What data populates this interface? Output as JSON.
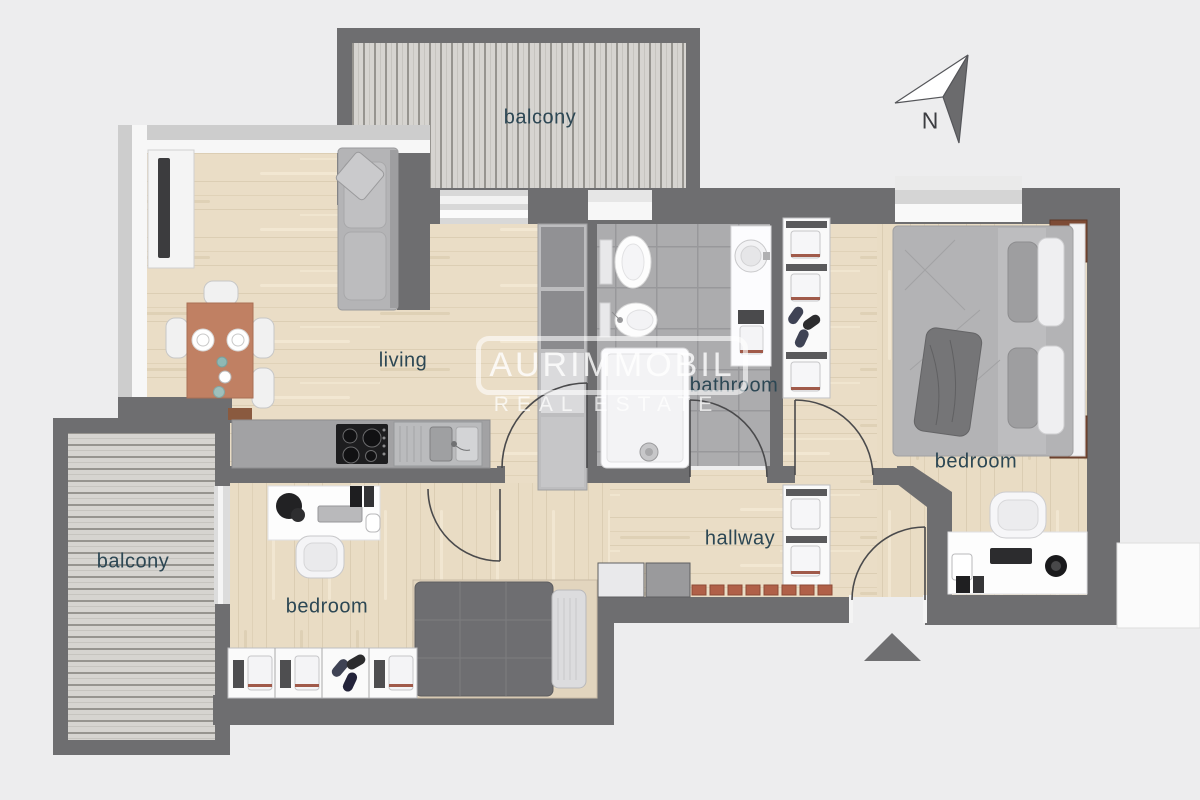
{
  "rooms": {
    "balcony_top": {
      "label": "balcony"
    },
    "living": {
      "label": "living"
    },
    "bathroom": {
      "label": "bathroom"
    },
    "bedroom_main": {
      "label": "bedroom"
    },
    "hallway": {
      "label": "hallway"
    },
    "bedroom_second": {
      "label": "bedroom"
    },
    "balcony_left": {
      "label": "balcony"
    }
  },
  "compass": {
    "north_label": "N"
  },
  "watermark": {
    "brand": "AURIMMOBIL",
    "tagline": "REAL ESTATE"
  },
  "colors": {
    "background": "#ededee",
    "wall": "#6e6e70",
    "wood_floor": "#eaddc6",
    "tile_floor": "#acacae",
    "balcony_deck": "#d6d4d0",
    "table_terracotta": "#c08063",
    "shoe_rack_terracotta": "#b06048",
    "nightstand_brown": "#7d4b35",
    "label_text": "#2c4754",
    "watermark_white": "rgba(255,255,255,0.75)"
  }
}
